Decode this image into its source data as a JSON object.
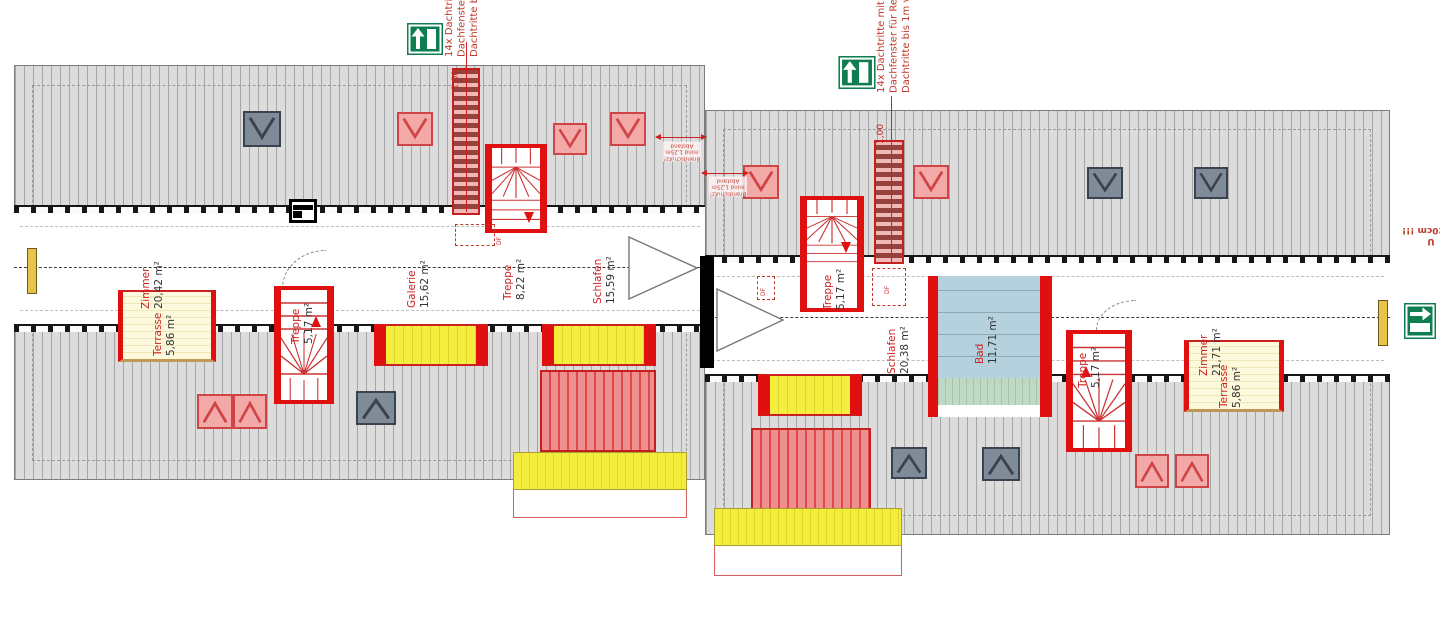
{
  "annotations": {
    "roof_note_left": {
      "lines": [
        "14x Dachtritte",
        "Dachfenster fü",
        "Dachtritte bis"
      ]
    },
    "roof_note_mid": {
      "lines": [
        "14x Dachtritte mit Han",
        "Dachfenster für Rettun",
        "Dachtritte bis 1m vor D"
      ]
    },
    "fire_note_a": {
      "lines": [
        "Brandschutz!",
        "mind 1,25m",
        "Abstand"
      ]
    },
    "fire_note_b": {
      "lines": [
        "Brandschutz!",
        "mind 1,25m",
        "Abstand"
      ]
    },
    "edge_note": {
      "lines": [
        "U",
        "x 120cm !!!"
      ]
    },
    "dim_left": "1,00",
    "dim_right": "1,00",
    "df_1": "DF",
    "df_2": "DF",
    "df_3": "DF"
  },
  "rooms": {
    "left": [
      {
        "name": "Zimmer",
        "area": "20,42 m²"
      },
      {
        "name": "Terrasse",
        "area": "5,86 m²"
      },
      {
        "name": "Treppe",
        "area": "5,17 m²"
      },
      {
        "name": "Galerie",
        "area": "15,62 m²"
      },
      {
        "name": "Treppe",
        "area": "8,22 m²"
      },
      {
        "name": "Schlafen",
        "area": "15,59 m²"
      }
    ],
    "right": [
      {
        "name": "Treppe",
        "area": "5,17 m²"
      },
      {
        "name": "Schlafen",
        "area": "20,38 m²"
      },
      {
        "name": "Bad",
        "area": "11,71 m²"
      },
      {
        "name": "Treppe",
        "area": "5,17 m²"
      },
      {
        "name": "Zimmer",
        "area": "21,71 m²"
      },
      {
        "name": "Terrasse",
        "area": "5,86 m²"
      }
    ]
  },
  "colors": {
    "wall_red": "#e01010",
    "annotation_red": "#c0392b",
    "roof_gray": "#dcdcdc",
    "skylight_pink": "#f4a9a9",
    "skylight_dark": "#7f8b98",
    "dormer_yellow": "#f5ee3e",
    "terrace_cream": "#fdf9dc",
    "bath_blue": "#b4d1dd",
    "bath_green": "#bfd9c5",
    "exit_green": "#0f7d52"
  }
}
